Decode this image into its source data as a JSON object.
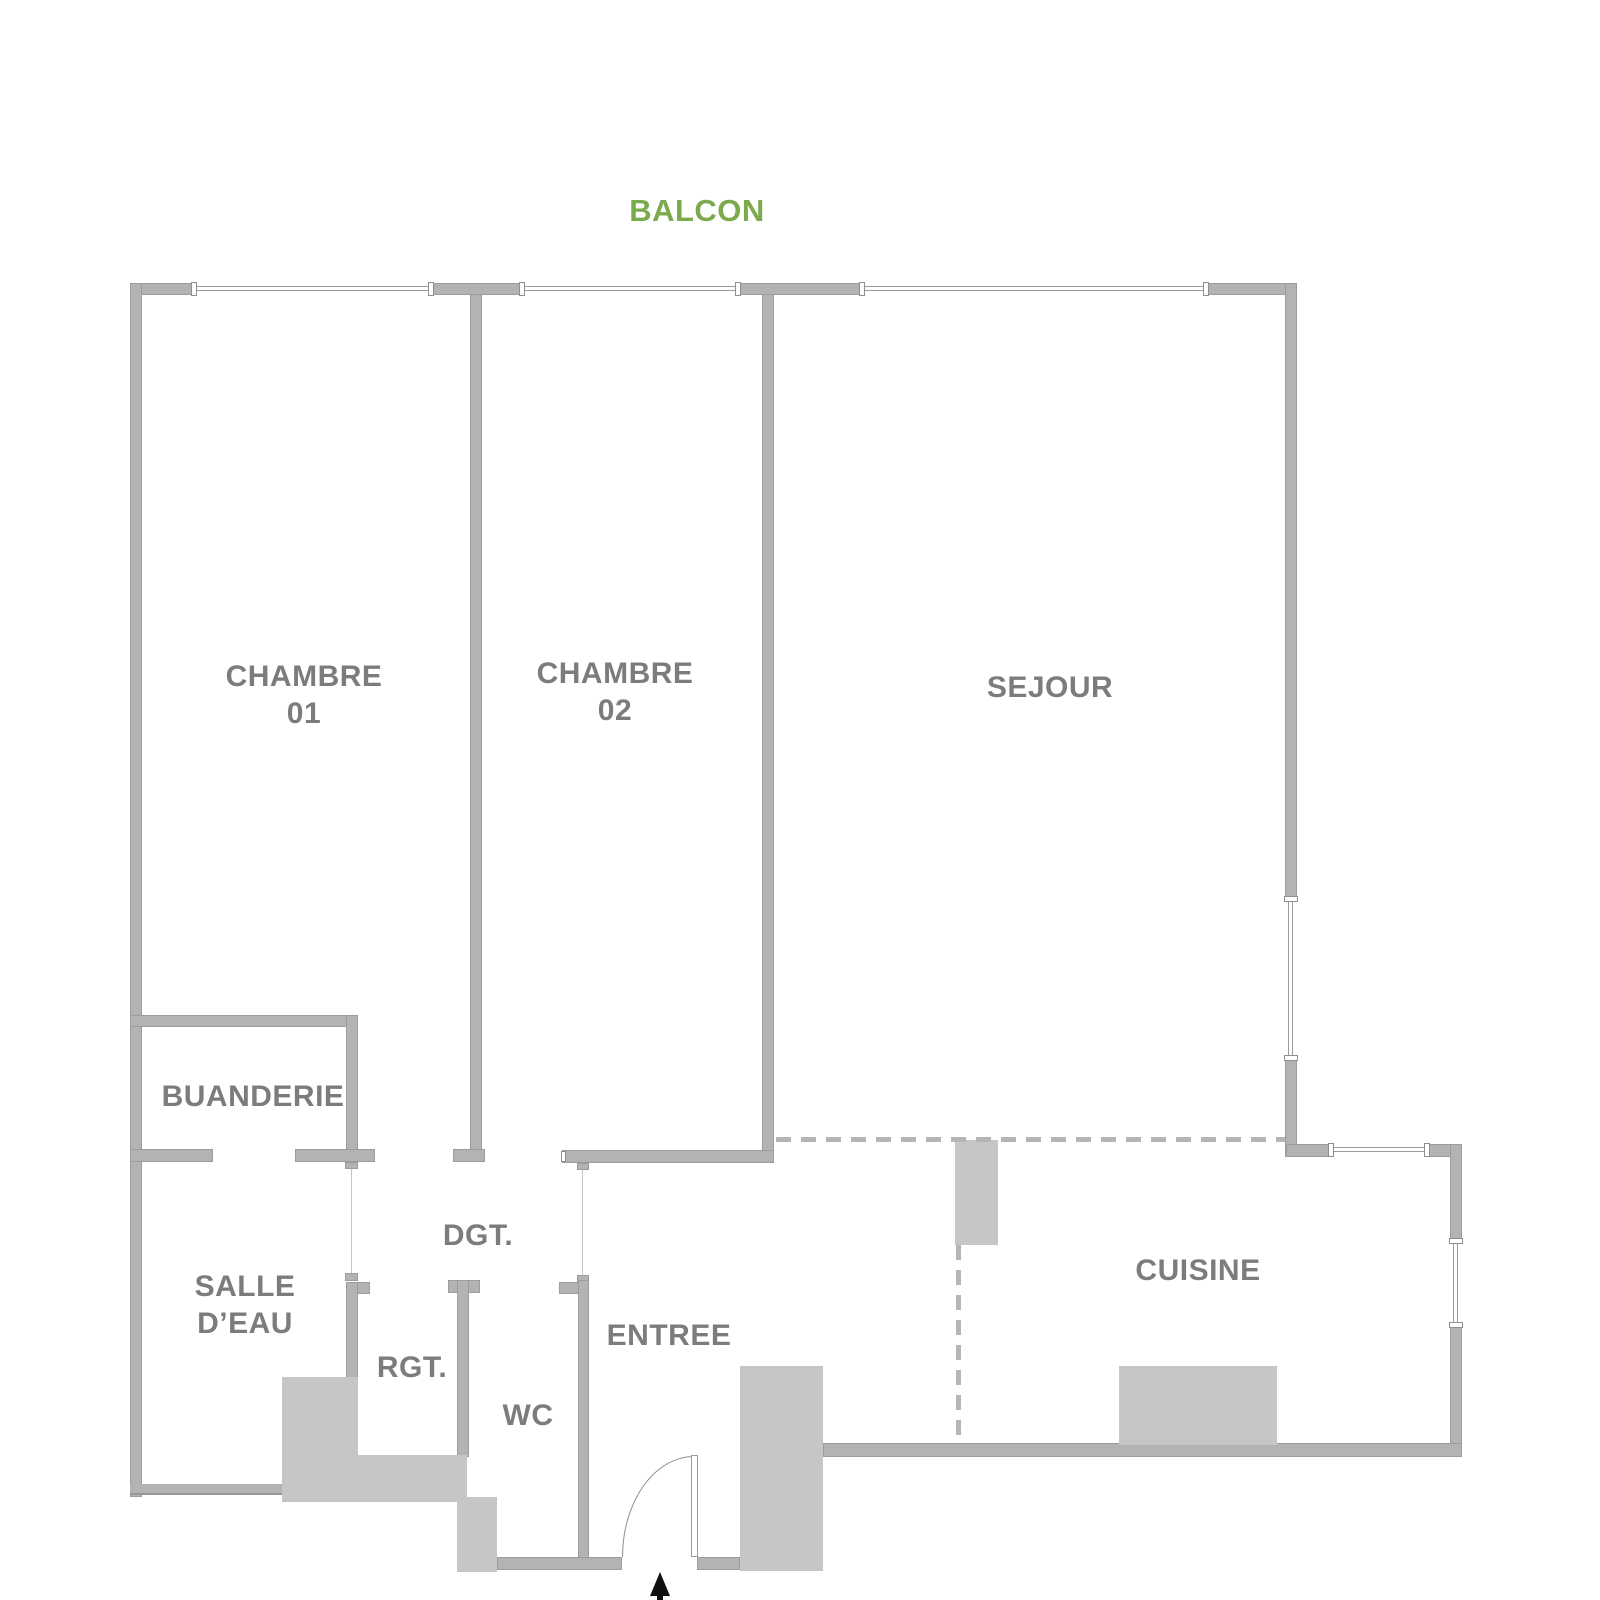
{
  "plan": {
    "balcony": {
      "label": "BALCON"
    },
    "rooms": {
      "chambre01": {
        "line1": "CHAMBRE",
        "line2": "01"
      },
      "chambre02": {
        "line1": "CHAMBRE",
        "line2": "02"
      },
      "sejour": {
        "label": "SEJOUR"
      },
      "buanderie": {
        "label": "BUANDERIE"
      },
      "salle_deau": {
        "line1": "SALLE",
        "line2": "D’EAU"
      },
      "dgt": {
        "label": "DGT."
      },
      "rgt": {
        "label": "RGT."
      },
      "wc": {
        "label": "WC"
      },
      "entree": {
        "label": "ENTREE"
      },
      "cuisine": {
        "label": "CUISINE"
      }
    }
  },
  "colors": {
    "wall": "#b3b3b3",
    "wall-edge": "#9c9c9c",
    "block": "#c6c6c6",
    "label": "#7c7c7c",
    "accent-green": "#7baa4d",
    "dash": "#b5b5b5",
    "arrow": "#111111"
  }
}
